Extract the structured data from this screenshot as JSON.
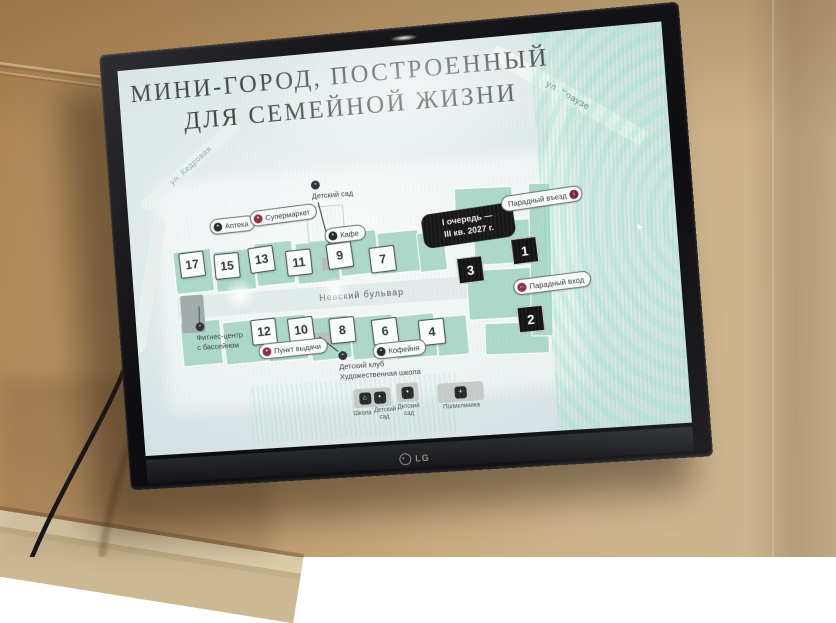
{
  "scene": {
    "brand": "LG"
  },
  "slide": {
    "title_line1": "МИНИ-ГОРОД, ПОСТРОЕННЫЙ",
    "title_line2": "ДЛЯ СЕМЕЙНОЙ ЖИЗНИ",
    "streets": {
      "kedrovaya": "ул. Кедровая",
      "krauze": "ул. Краузе",
      "nevsky": "Невский бульвар"
    },
    "phase_box": {
      "line1": "I очередь —",
      "line2": "III кв. 2027 г."
    },
    "buildings_top": [
      "17",
      "15",
      "13",
      "11",
      "9",
      "7"
    ],
    "buildings_bottom": [
      "12",
      "10",
      "8",
      "6",
      "4"
    ],
    "phase_squares": [
      "1",
      "2",
      "3"
    ],
    "pois": {
      "pharmacy": "Аптека",
      "supermarket": "Супермаркет",
      "cafe": "Кафе",
      "pickup": "Пункт выдачи",
      "coffee": "Кофейня",
      "main_drive": "Парадный въезд",
      "main_entrance": "Парадный вход"
    },
    "callouts": {
      "kindergarten": "Детский сад",
      "kids_club_line1": "Детский клуб",
      "kids_club_line2": "Художественная школа",
      "fitness_line1": "Фитнес-центр",
      "fitness_line2": "с бассейном"
    },
    "legend": {
      "school": "Школа",
      "kindergarten_a": "Детский сад",
      "kindergarten_b": "Детский сад",
      "polyclinic": "Поликлиника"
    },
    "icons": {
      "pharmacy": "+",
      "supermarket": "▪",
      "cafe": "•",
      "pickup": "▪",
      "coffee": "•",
      "main_drive": "↓",
      "main_entrance": "←",
      "kindergarten": "•",
      "kids_club": "•",
      "fitness": "•",
      "school": "⌂",
      "kindergarten_sq": "•",
      "polyclinic": "+"
    },
    "colors": {
      "accent_red": "#8e2f3c",
      "icon_dark": "#23292b",
      "building_teal": "#abd8c8"
    }
  }
}
